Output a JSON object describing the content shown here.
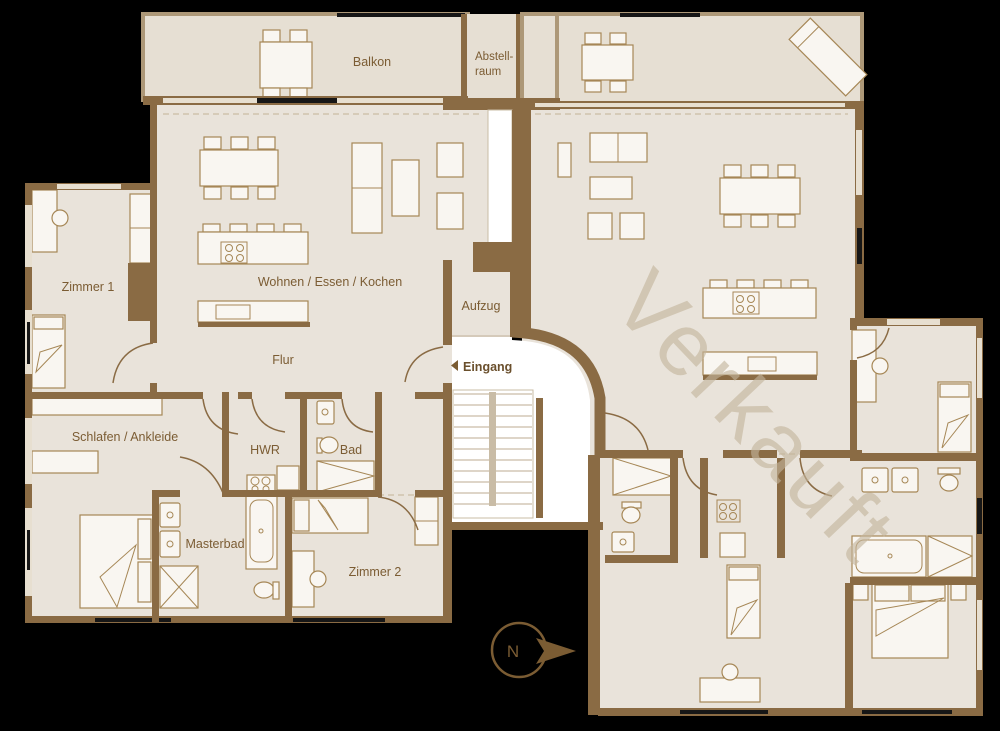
{
  "colors": {
    "background": "#000000",
    "floor": "#e9e3da",
    "balcony_floor": "#e6dfd3",
    "balcony_border": "#ad9878",
    "wall": "#8a6b44",
    "furniture_fill": "#f9f6f1",
    "furniture_stroke": "#a68756",
    "window_light": "#e7dfd0",
    "window_dark": "#161616",
    "stair_line": "#c9bca6",
    "dash_line": "#cfc3ad",
    "text": "#7b5c33",
    "text_dark": "#6a4f2c",
    "watermark": "#c3b59c",
    "white": "#ffffff"
  },
  "labels": {
    "balkon": "Balkon",
    "abstellraum_line1": "Abstell-",
    "abstellraum_line2": "raum",
    "zimmer1": "Zimmer 1",
    "wohnen": "Wohnen / Essen / Kochen",
    "flur": "Flur",
    "aufzug": "Aufzug",
    "eingang": "Eingang",
    "schlafen": "Schlafen / Ankleide",
    "hwr": "HWR",
    "bad": "Bad",
    "masterbad": "Masterbad",
    "zimmer2": "Zimmer 2"
  },
  "watermark": "Verkauft",
  "compass_n": "N"
}
